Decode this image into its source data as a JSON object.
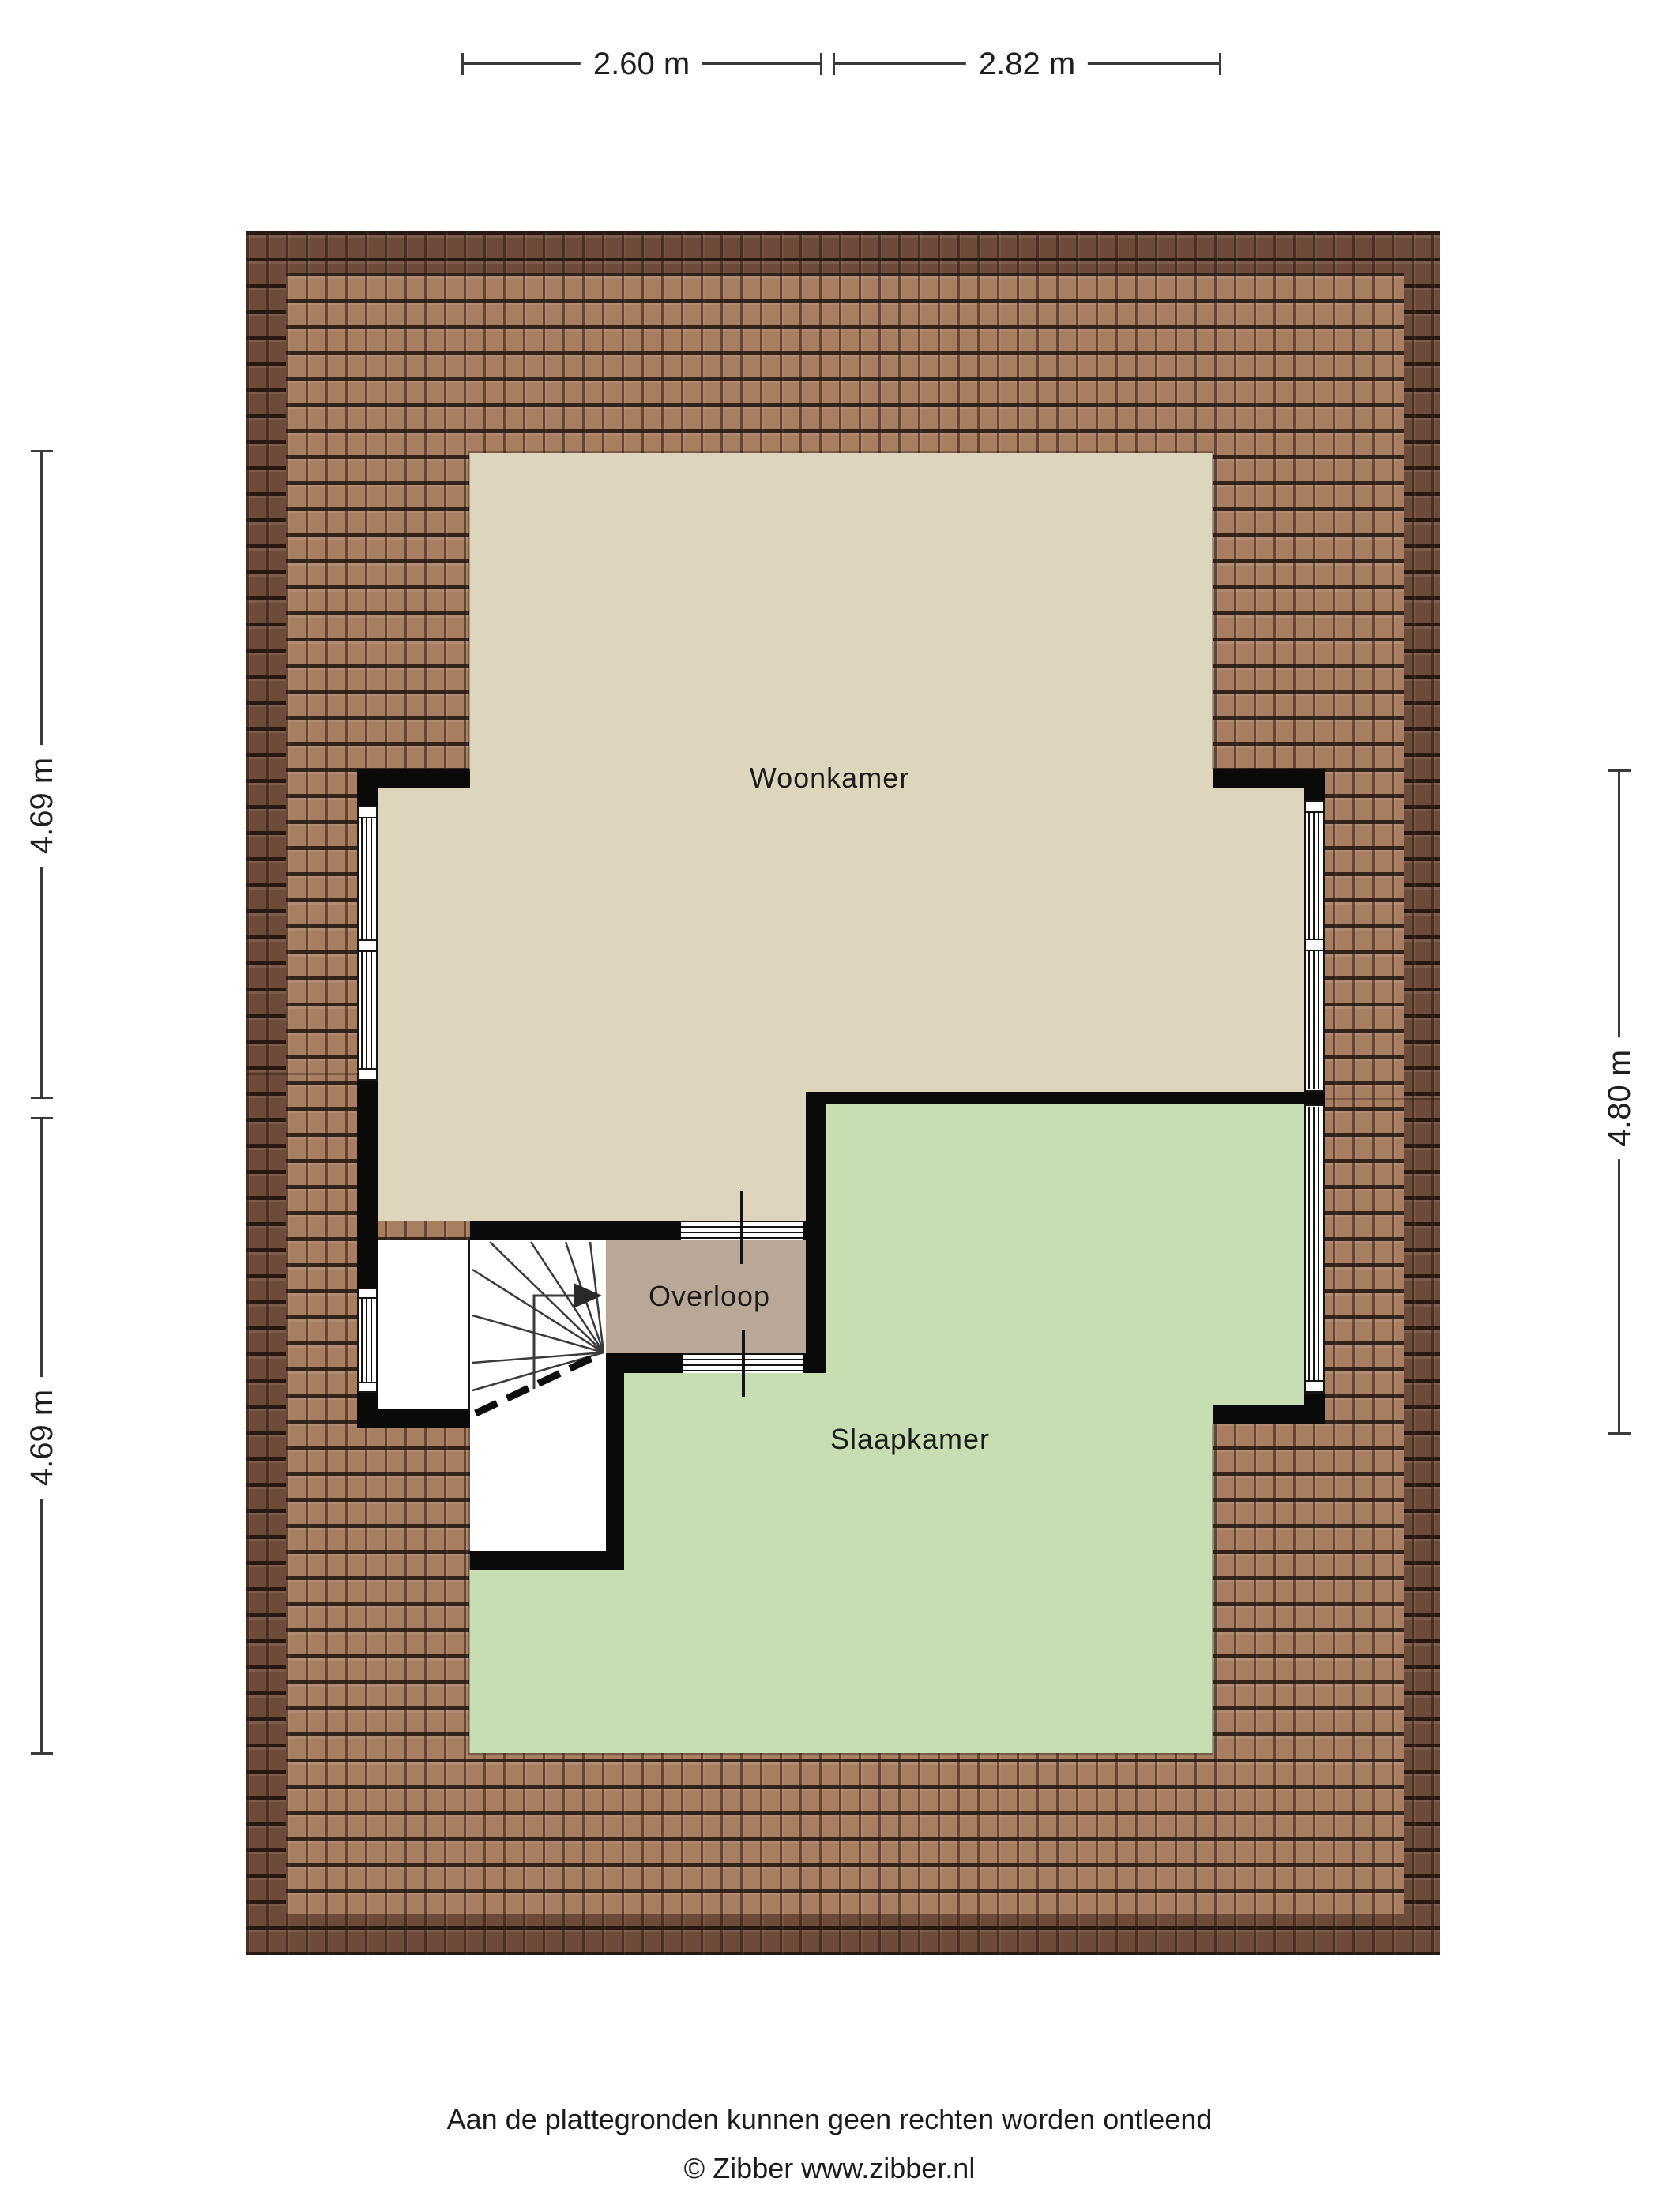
{
  "plan": {
    "rooms": [
      {
        "id": "woonkamer",
        "label": "Woonkamer"
      },
      {
        "id": "overloop",
        "label": "Overloop"
      },
      {
        "id": "slaapkamer",
        "label": "Slaapkamer"
      }
    ],
    "dimensions": {
      "top": [
        {
          "label": "2.60 m"
        },
        {
          "label": "2.82 m"
        }
      ],
      "left": [
        {
          "label": "4.69 m"
        },
        {
          "label": "4.69 m"
        }
      ],
      "right": [
        {
          "label": "4.80 m"
        }
      ]
    },
    "stairs": {
      "direction": "up",
      "arrow": "right"
    }
  },
  "footer": {
    "disclaimer": "Aan de plattegronden kunnen geen rechten worden ontleend",
    "credit": "© Zibber www.zibber.nl"
  },
  "colors": {
    "roof_frame": "#6e4a39",
    "roof_field": "#a87e61",
    "room_woonkamer": "#ded6bc",
    "room_slaapkamer": "#c6deb2",
    "room_overloop": "#b9a898",
    "wall": "#0a0a0a",
    "dim_line": "#3a3a3a",
    "text": "#1f1f1f"
  }
}
